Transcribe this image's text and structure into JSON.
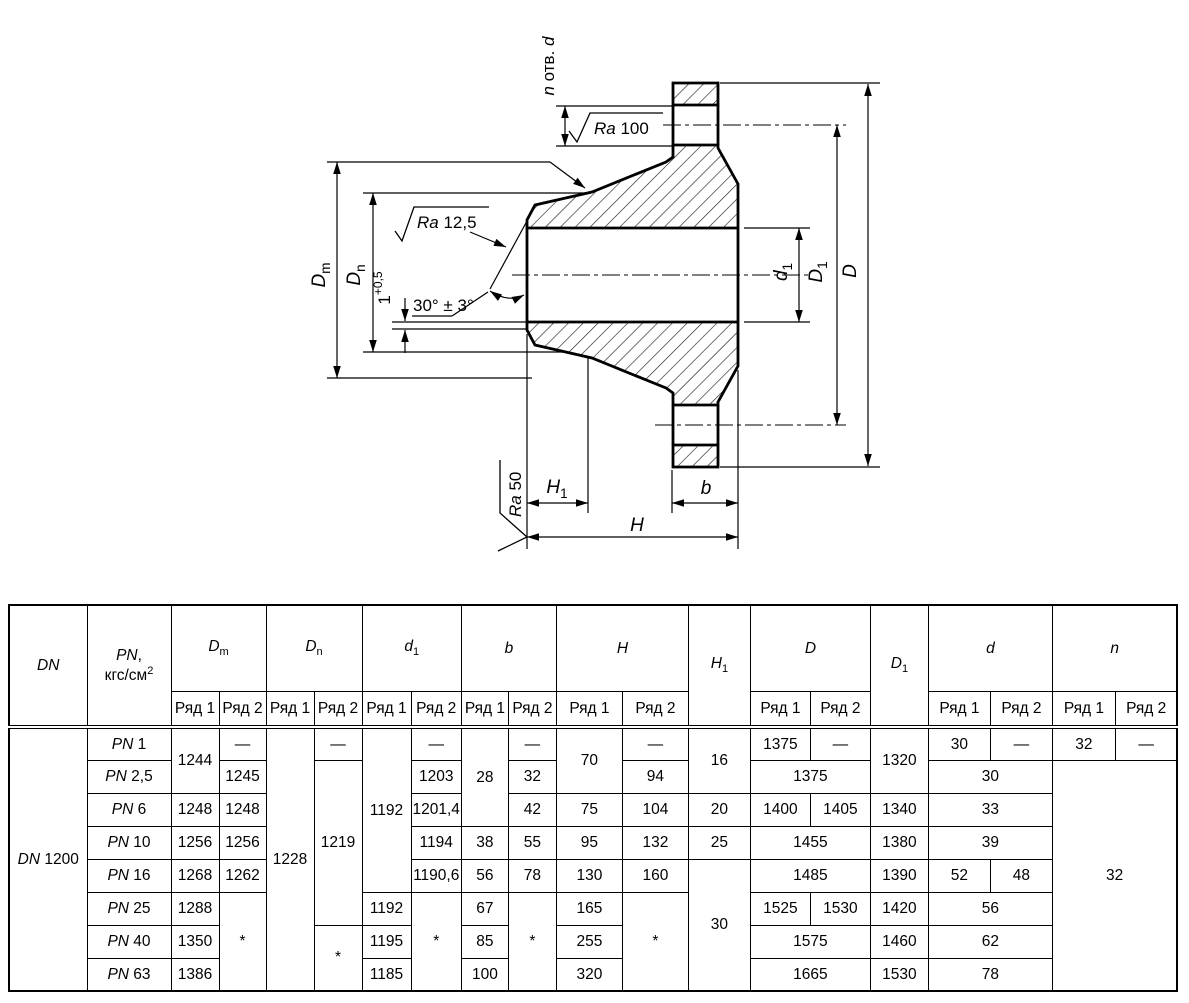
{
  "drawing": {
    "labels": {
      "n_holes": "*n* отв. *d*",
      "ra100": "*Ra* 100",
      "ra125": "*Ra* 12,5",
      "ra50": "*Ra* 50",
      "angle": "30° ± 3°",
      "land": "1^+0,5^",
      "Dm": "*D*_m_",
      "Dn": "*D*_n_",
      "d1": "*d*_1_",
      "D1": "*D*_1_",
      "D": "*D*",
      "H1": "*H*_1_",
      "H": "*H*",
      "b": "*b*"
    }
  },
  "table": {
    "header_row1": [
      {
        "t": "*DN*",
        "rs": 2
      },
      {
        "t": "*PN*,|кгс/см^2^",
        "rs": 2
      },
      {
        "t": "*D*_m_",
        "cs": 2
      },
      {
        "t": "*D*_n_",
        "cs": 2
      },
      {
        "t": "*d*_1_",
        "cs": 2
      },
      {
        "t": "*b*",
        "cs": 2
      },
      {
        "t": "*H*",
        "cs": 2
      },
      {
        "t": "*H*_1_",
        "rs": 2
      },
      {
        "t": "*D*",
        "cs": 2
      },
      {
        "t": "*D*_1_",
        "rs": 2
      },
      {
        "t": "*d*",
        "cs": 2
      },
      {
        "t": "*n*",
        "cs": 2
      }
    ],
    "header_row2": [
      "Ряд 1",
      "Ряд 2",
      "Ряд 1",
      "Ряд 2",
      "Ряд 1",
      "Ряд 2",
      "Ряд 1",
      "Ряд 2",
      "Ряд 1",
      "Ряд 2",
      "Ряд 1",
      "Ряд 2",
      "Ряд 1",
      "Ряд 2",
      "Ряд 1",
      "Ряд 2"
    ],
    "body": [
      [
        {
          "t": "*DN* 1200",
          "rs": 8
        },
        {
          "t": "*PN* 1"
        },
        {
          "t": "1244",
          "rs": 2
        },
        {
          "t": "—"
        },
        {
          "t": "1228",
          "rs": 8
        },
        {
          "t": "—"
        },
        {
          "t": "1192",
          "rs": 5
        },
        {
          "t": "—"
        },
        {
          "t": "28",
          "rs": 3
        },
        {
          "t": "—"
        },
        {
          "t": "70",
          "rs": 2
        },
        {
          "t": "—"
        },
        {
          "t": "16",
          "rs": 2
        },
        {
          "t": "1375"
        },
        {
          "t": "—"
        },
        {
          "t": "1320",
          "rs": 2
        },
        {
          "t": "30"
        },
        {
          "t": "—"
        },
        {
          "t": "32"
        },
        {
          "t": "—"
        }
      ],
      [
        {
          "t": "*PN* 2,5"
        },
        {
          "t": "1245"
        },
        {
          "t": "1219",
          "rs": 5
        },
        {
          "t": "1203"
        },
        {
          "t": "32"
        },
        {
          "t": "94"
        },
        {
          "t": "1375",
          "cs": 2
        },
        {
          "t": "30",
          "cs": 2
        },
        {
          "t": "32",
          "cs": 2,
          "rs": 7
        }
      ],
      [
        {
          "t": "*PN* 6"
        },
        {
          "t": "1248"
        },
        {
          "t": "1248"
        },
        {
          "t": "1201,4"
        },
        {
          "t": "42"
        },
        {
          "t": "75"
        },
        {
          "t": "104"
        },
        {
          "t": "20"
        },
        {
          "t": "1400"
        },
        {
          "t": "1405"
        },
        {
          "t": "1340"
        },
        {
          "t": "33",
          "cs": 2
        }
      ],
      [
        {
          "t": "*PN* 10"
        },
        {
          "t": "1256"
        },
        {
          "t": "1256"
        },
        {
          "t": "1194"
        },
        {
          "t": "38"
        },
        {
          "t": "55"
        },
        {
          "t": "95"
        },
        {
          "t": "132"
        },
        {
          "t": "25"
        },
        {
          "t": "1455",
          "cs": 2
        },
        {
          "t": "1380"
        },
        {
          "t": "39",
          "cs": 2
        }
      ],
      [
        {
          "t": "*PN* 16"
        },
        {
          "t": "1268"
        },
        {
          "t": "1262"
        },
        {
          "t": "1190,6"
        },
        {
          "t": "56"
        },
        {
          "t": "78"
        },
        {
          "t": "130"
        },
        {
          "t": "160"
        },
        {
          "t": "30",
          "rs": 4
        },
        {
          "t": "1485",
          "cs": 2
        },
        {
          "t": "1390"
        },
        {
          "t": "52"
        },
        {
          "t": "48"
        }
      ],
      [
        {
          "t": "*PN* 25"
        },
        {
          "t": "1288"
        },
        {
          "t": "*",
          "rs": 3
        },
        {
          "t": "1192"
        },
        {
          "t": "*",
          "rs": 3
        },
        {
          "t": "67"
        },
        {
          "t": "*",
          "rs": 3
        },
        {
          "t": "165"
        },
        {
          "t": "*",
          "rs": 3
        },
        {
          "t": "1525"
        },
        {
          "t": "1530"
        },
        {
          "t": "1420"
        },
        {
          "t": "56",
          "cs": 2
        }
      ],
      [
        {
          "t": "*PN* 40"
        },
        {
          "t": "1350"
        },
        {
          "t": "*",
          "rs": 2
        },
        {
          "t": "1195"
        },
        {
          "t": "85"
        },
        {
          "t": "255"
        },
        {
          "t": "1575",
          "cs": 2
        },
        {
          "t": "1460"
        },
        {
          "t": "62",
          "cs": 2
        }
      ],
      [
        {
          "t": "*PN* 63"
        },
        {
          "t": "1386"
        },
        {
          "t": "1185"
        },
        {
          "t": "100"
        },
        {
          "t": "320"
        },
        {
          "t": "1665",
          "cs": 2
        },
        {
          "t": "1530"
        },
        {
          "t": "78",
          "cs": 2
        }
      ]
    ]
  }
}
